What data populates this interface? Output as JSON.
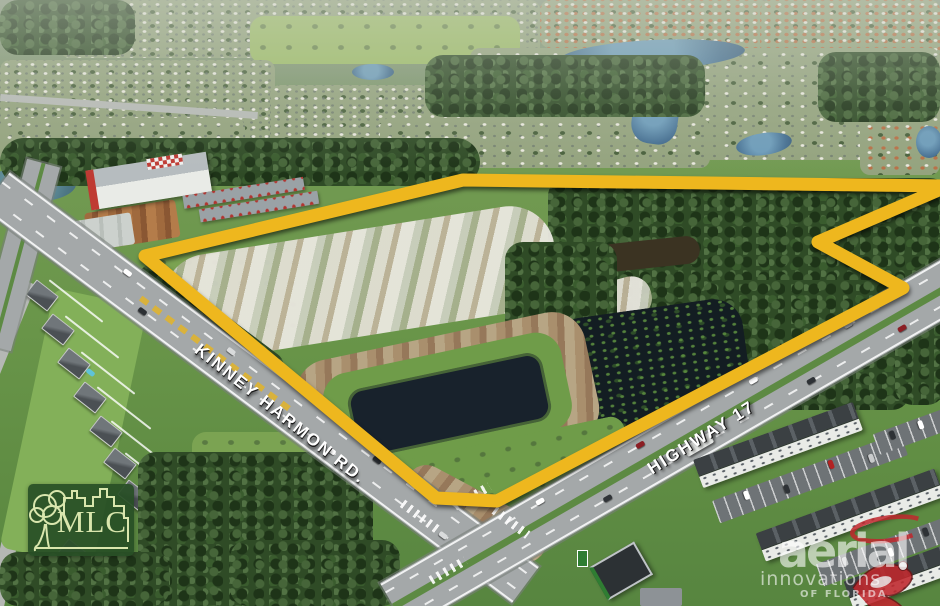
{
  "scene": {
    "type": "aerial-photograph",
    "description": "Aerial marketing photo of a vacant land parcel outlined in yellow at the corner of Kinney Harmon Rd. and Highway 17, surrounded by residential neighborhoods, a self-storage facility, apartments and a retention pond"
  },
  "labels": {
    "kinney": "KINNEY HARMON RD.",
    "highway": "HIGHWAY 17"
  },
  "logo": {
    "text": "MLC"
  },
  "watermark": {
    "line1": "aerial",
    "line2": "innovations",
    "line3": "OF FLORIDA"
  },
  "boundary": {
    "points": "145,256 463,180 948,186 818,242 903,288 497,501 436,498",
    "stroke_width": 13
  },
  "colors": {
    "boundaryYellow": "#eeb71e",
    "mlcGreen": "rgba(40,79,38,0.93)",
    "mlcLight": "#d9e6ad",
    "watermarkRed": "#c0272d",
    "watermarkWhite": "rgba(255,255,255,0.6)"
  }
}
